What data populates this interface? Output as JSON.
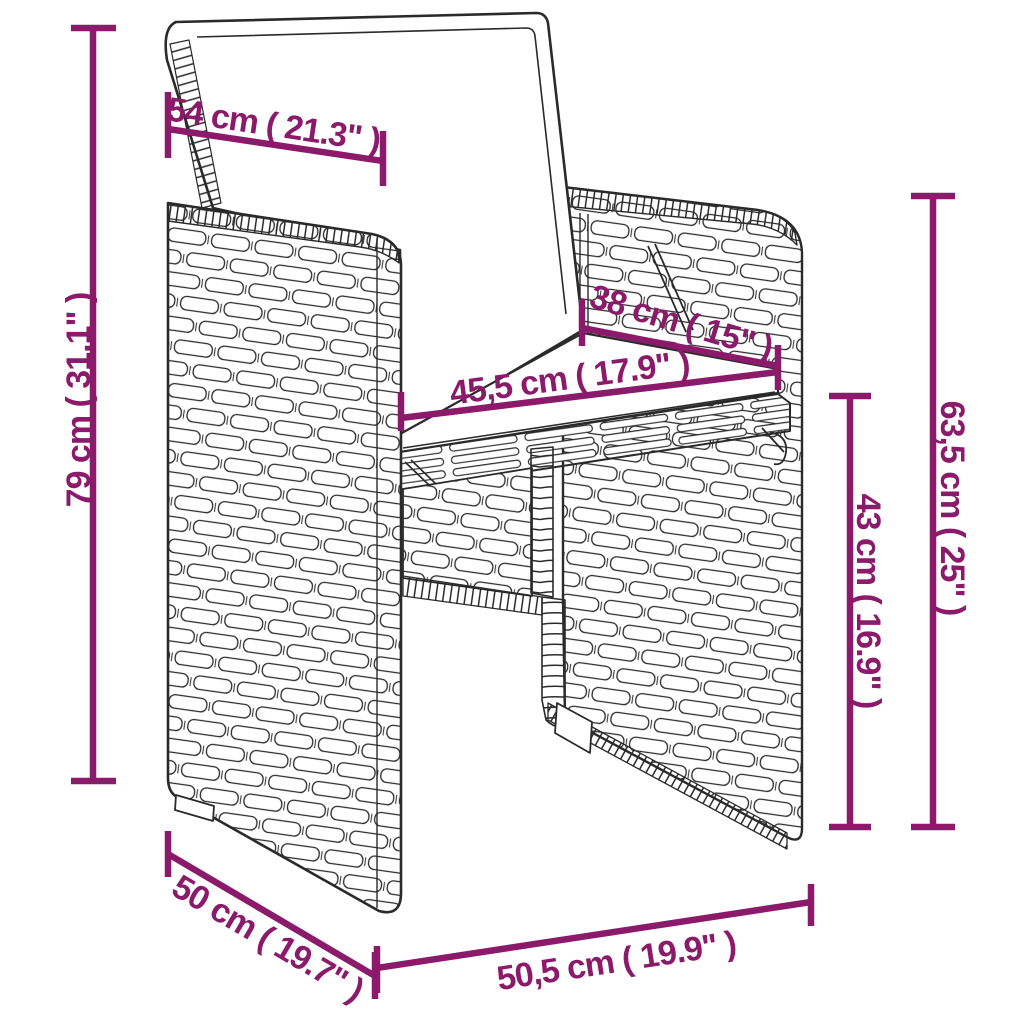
{
  "diagram": {
    "type": "product-dimension-diagram",
    "subject": "poly rattan garden armchair with back and seat cushions",
    "accent_color": "#8b1a6b",
    "outline_color": "#2a2a2a",
    "background_color": "#ffffff",
    "dimensions": [
      {
        "name": "backrest-cushion-width",
        "label": "54 cm ( 21.3\" )",
        "value_cm": "54",
        "value_in": "21.3"
      },
      {
        "name": "total-height",
        "label": "79 cm ( 31.1\" )",
        "value_cm": "79",
        "value_in": "31.1"
      },
      {
        "name": "seat-depth",
        "label": "38 cm ( 15\" )",
        "value_cm": "38",
        "value_in": "15"
      },
      {
        "name": "seat-width",
        "label": "45,5 cm ( 17.9\" )",
        "value_cm": "45,5",
        "value_in": "17.9"
      },
      {
        "name": "armrest-height",
        "label": "63,5 cm ( 25\" )",
        "value_cm": "63,5",
        "value_in": "25"
      },
      {
        "name": "seat-height",
        "label": "43 cm ( 16.9\" )",
        "value_cm": "43",
        "value_in": "16.9"
      },
      {
        "name": "base-depth",
        "label": "50 cm ( 19.7\" )",
        "value_cm": "50",
        "value_in": "19.7"
      },
      {
        "name": "base-width",
        "label": "50,5 cm ( 19.9\" )",
        "value_cm": "50,5",
        "value_in": "19.9"
      }
    ]
  }
}
